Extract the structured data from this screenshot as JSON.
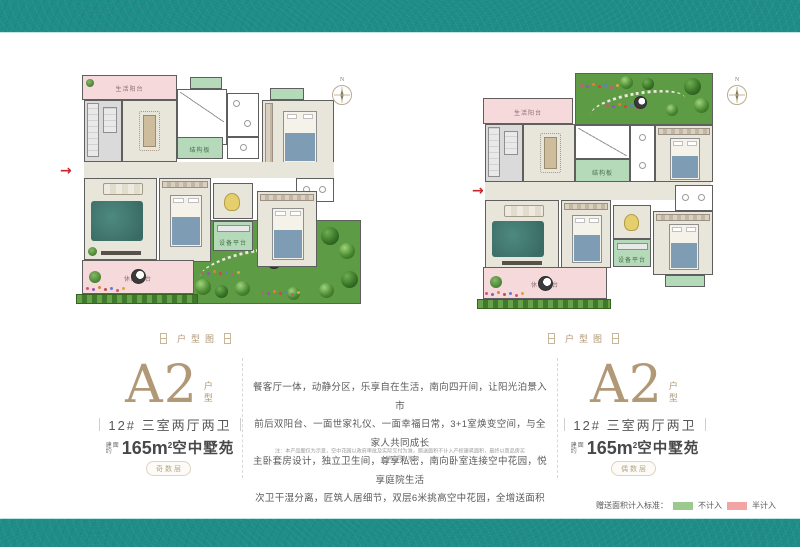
{
  "theme": {
    "teal": "#1e8c87",
    "teal_edge": "#bfe6e3",
    "bronze": "#b19876",
    "text_dark": "#47484a",
    "balcony_pink": "#f6d9db",
    "room_green": "#b5dab9",
    "garden_green": "#5e9b45",
    "legend_green": "#9cc98e",
    "legend_pink": "#f2a3a3",
    "entry_red": "#c9252c"
  },
  "icons": {
    "entry_arrow": "→"
  },
  "plans": {
    "compass": "N",
    "labels": {
      "living_balcony": "生活阳台",
      "structure_slab": "结构板",
      "equipment_platform": "设备平台",
      "leisure_balcony": "休闲阳台"
    }
  },
  "sections": {
    "left": {
      "tag": "户型图",
      "name": "A2",
      "name_suffix": "户型",
      "building": "12#  三室两厅两卫",
      "area_prefix_top": "建面",
      "area_prefix_bottom": "约",
      "area_value": "165m",
      "area_sup": "2",
      "area_suffix": "空中墅苑",
      "badge": "奇数层"
    },
    "right": {
      "tag": "户型图",
      "name": "A2",
      "name_suffix": "户型",
      "building": "12#  三室两厅两卫",
      "area_prefix_top": "建面",
      "area_prefix_bottom": "约",
      "area_value": "165m",
      "area_sup": "2",
      "area_suffix": "空中墅苑",
      "badge": "偶数层"
    }
  },
  "description": {
    "lines": [
      "餐客厅一体，动静分区，乐享自在生活，南向四开间，让阳光泊景入市",
      "前后双阳台、一面世家礼仪、一面幸福日常，3+1室焕变空间，与全家人共同成长",
      "主卧套房设计，独立卫生间，尊享私密，南向卧室连接空中花园，悦享庭院生活",
      "次卫干湿分离，匠筑人居细节，双层6米挑高空中花园，全增送面积"
    ],
    "disclaimer": "注：本产品图仅为示意，空中花园以政府审批及实际交付为准，赠送面积不计入产权建筑面积，最终以商品房买卖合同为准"
  },
  "legend": {
    "title": "赠送面积计入标准：",
    "items": [
      {
        "label": "不计入",
        "color": "#9cc98e"
      },
      {
        "label": "半计入",
        "color": "#f2a3a3"
      }
    ]
  }
}
